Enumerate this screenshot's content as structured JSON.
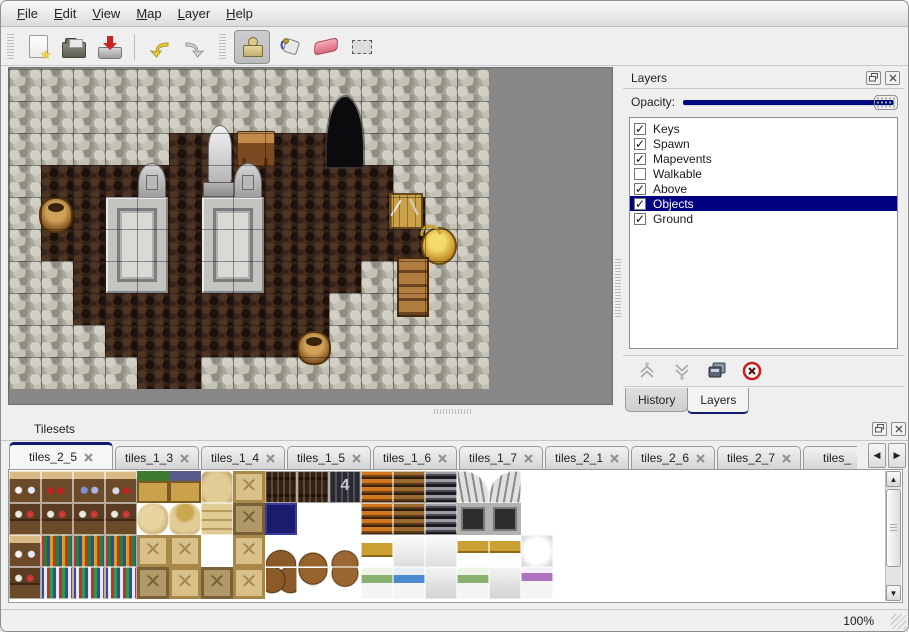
{
  "menubar": {
    "items": [
      {
        "label": "File"
      },
      {
        "label": "Edit"
      },
      {
        "label": "View"
      },
      {
        "label": "Map"
      },
      {
        "label": "Layer"
      },
      {
        "label": "Help"
      }
    ]
  },
  "toolbar": {
    "buttons": [
      "new",
      "open",
      "save",
      "undo",
      "redo",
      "stamp",
      "fill",
      "eraser",
      "select"
    ],
    "selected_tool": "stamp"
  },
  "map": {
    "grid": [
      "WWWWWWWWWWWWWWW",
      "WWWWWWWWWWWWWWW",
      "WWWWWFFFFFWWWWW",
      "WFFFFFFFFFFFWWW",
      "WFFFFFFFFFFFFWW",
      "WFFFFFFFFFFFFWW",
      "WWFFFFFFFFFWWWW",
      "WWFFFFFFFFWWWWW",
      "WWWFFFFFFFWWWWW",
      "WWWWFFWWWWWWWWW"
    ],
    "objects": [
      {
        "name": "cave-entrance",
        "kind": "cave",
        "x": 318,
        "y": 28,
        "w": 36,
        "h": 70
      },
      {
        "name": "statue",
        "kind": "statue",
        "x": 194,
        "y": 56,
        "w": 34,
        "h": 72
      },
      {
        "name": "wooden-table",
        "kind": "table",
        "x": 228,
        "y": 62,
        "w": 38,
        "h": 36
      },
      {
        "name": "gravestone-left",
        "kind": "grave",
        "x": 129,
        "y": 94,
        "w": 28,
        "h": 36
      },
      {
        "name": "gravestone-right",
        "kind": "grave",
        "x": 225,
        "y": 94,
        "w": 28,
        "h": 36
      },
      {
        "name": "stone-platform-left",
        "kind": "platform",
        "x": 97,
        "y": 128,
        "w": 62,
        "h": 96
      },
      {
        "name": "stone-platform-right",
        "kind": "platform",
        "x": 193,
        "y": 128,
        "w": 62,
        "h": 96
      },
      {
        "name": "basket-left",
        "kind": "basket",
        "x": 30,
        "y": 128,
        "w": 34,
        "h": 36
      },
      {
        "name": "crate-with-tools",
        "kind": "crate-tools",
        "x": 380,
        "y": 124,
        "w": 34,
        "h": 36
      },
      {
        "name": "golden-pot",
        "kind": "pot-gold",
        "x": 412,
        "y": 158,
        "w": 36,
        "h": 38
      },
      {
        "name": "wooden-cabinet",
        "kind": "cabinet",
        "x": 388,
        "y": 188,
        "w": 32,
        "h": 60
      },
      {
        "name": "basket-bottom",
        "kind": "basket",
        "x": 288,
        "y": 262,
        "w": 34,
        "h": 34
      }
    ]
  },
  "layers_panel": {
    "title": "Layers",
    "opacity_label": "Opacity:",
    "opacity_value": 100,
    "layers": [
      {
        "label": "Keys",
        "checked": true,
        "selected": false
      },
      {
        "label": "Spawn",
        "checked": true,
        "selected": false
      },
      {
        "label": "Mapevents",
        "checked": true,
        "selected": false
      },
      {
        "label": "Walkable",
        "checked": false,
        "selected": false
      },
      {
        "label": "Above",
        "checked": true,
        "selected": false
      },
      {
        "label": "Objects",
        "checked": true,
        "selected": true
      },
      {
        "label": "Ground",
        "checked": true,
        "selected": false
      }
    ],
    "buttons": [
      "move-layer-up",
      "move-layer-down",
      "duplicate-layer",
      "delete-layer"
    ],
    "dock_tabs": [
      {
        "label": "History",
        "active": false
      },
      {
        "label": "Layers",
        "active": true
      }
    ]
  },
  "tilesets_panel": {
    "title": "Tilesets",
    "tabs": [
      {
        "label": "tiles_2_5",
        "active": true
      },
      {
        "label": "tiles_1_3",
        "active": false
      },
      {
        "label": "tiles_1_4",
        "active": false
      },
      {
        "label": "tiles_1_5",
        "active": false
      },
      {
        "label": "tiles_1_6",
        "active": false
      },
      {
        "label": "tiles_1_7",
        "active": false
      },
      {
        "label": "tiles_2_1",
        "active": false
      },
      {
        "label": "tiles_2_6",
        "active": false
      },
      {
        "label": "tiles_2_7",
        "active": false
      },
      {
        "label": "tiles_",
        "active": false
      }
    ],
    "palette": {
      "rows": [
        [
          "shelfA",
          "shelfB",
          "shelfC",
          "shelfD",
          "cratePlant",
          "crateGrape",
          "sackTall",
          "crateX",
          "keg",
          "keg",
          "kegNum",
          "ladderO",
          "ladderB",
          "ladderK",
          "archL",
          "archR",
          ""
        ],
        [
          "shelfLo",
          "shelfLo",
          "shelfLo",
          "shelfLo",
          "sackRound",
          "sackOpen",
          "sackStack",
          "crateXd",
          "boxBlue",
          "",
          "",
          "ladderO",
          "ladderB",
          "ladderK",
          "door",
          "door",
          ""
        ],
        [
          "shelfA",
          "bookTop",
          "bookTop",
          "bookTop",
          "crateX",
          "crateX",
          "",
          "crateX",
          "barrelsT",
          "barrelT",
          "potsT",
          "bedGoldH",
          "bedWhiteT",
          "bedWhiteT",
          "pipeGold",
          "pipeGold",
          "pillow"
        ],
        [
          "shelfLo",
          "bookBot",
          "bookBot",
          "bookBot",
          "crateXd",
          "crateX",
          "crateXd",
          "crateX",
          "barrelsB",
          "barrelB",
          "potsB",
          "bedGreen",
          "bedBlue",
          "bedWhiteB",
          "bedGreen",
          "bedWhiteB",
          "bedPurple"
        ]
      ],
      "selection": {
        "col": 8,
        "row": 2,
        "cols": 2,
        "rows": 2
      }
    }
  },
  "statusbar": {
    "zoom": "100%"
  }
}
